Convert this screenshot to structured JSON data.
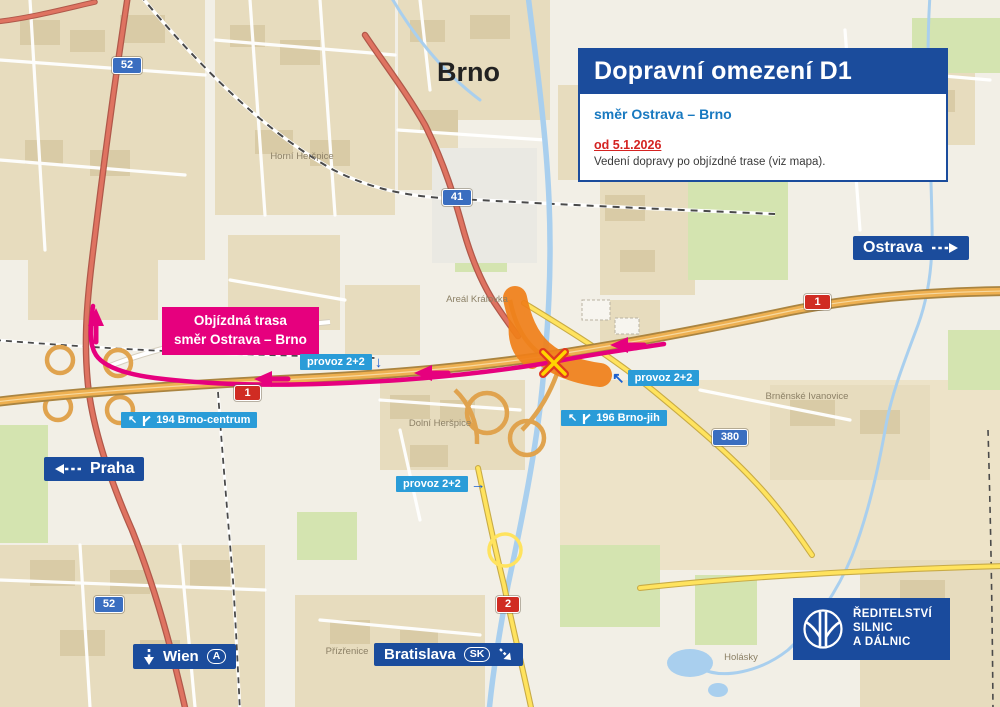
{
  "info_box": {
    "title": "Dopravní omezení D1",
    "subtitle": "směr Ostrava – Brno",
    "date": "od 5.1.2026",
    "note": "Vedení dopravy po objízdné trase (viz mapa)."
  },
  "detour_box": {
    "line1": "Objízdná trasa",
    "line2": "směr Ostrava – Brno"
  },
  "signs": {
    "ostrava": "Ostrava",
    "praha": "Praha",
    "wien": "Wien",
    "wien_badge": "A",
    "bratislava": "Bratislava",
    "bratislava_badge": "SK"
  },
  "traffic": {
    "provoz_a": "provoz 2+2",
    "provoz_b": "provoz 2+2",
    "provoz_c": "provoz 2+2",
    "exit_194": "194 Brno-centrum",
    "exit_196": "196 Brno-jih"
  },
  "shields": {
    "s52_top": "52",
    "s41": "41",
    "s380": "380",
    "s52_bottom": "52",
    "s2": "2",
    "d1_left": "1",
    "d1_right": "1"
  },
  "city_label": "Brno",
  "places": {
    "horni_herspice": "Horní Heršpice",
    "areal_kralovka": "Areál Královka",
    "dolni_herspice": "Dolní Heršpice",
    "brnenske_ivanovice": "Brněnské Ivanovice",
    "prizrenice": "Přízřenice",
    "holasky": "Holásky"
  },
  "logo": {
    "line1": "ŘEDITELSTVÍ",
    "line2": "SILNIC",
    "line3": "A DÁLNIC"
  },
  "colors": {
    "brand_blue": "#1b4c9c",
    "light_blue": "#2a9cd8",
    "magenta": "#e6007e",
    "closure_orange": "#f08019",
    "date_red": "#d42321",
    "highway_orange": "#eeb051"
  }
}
